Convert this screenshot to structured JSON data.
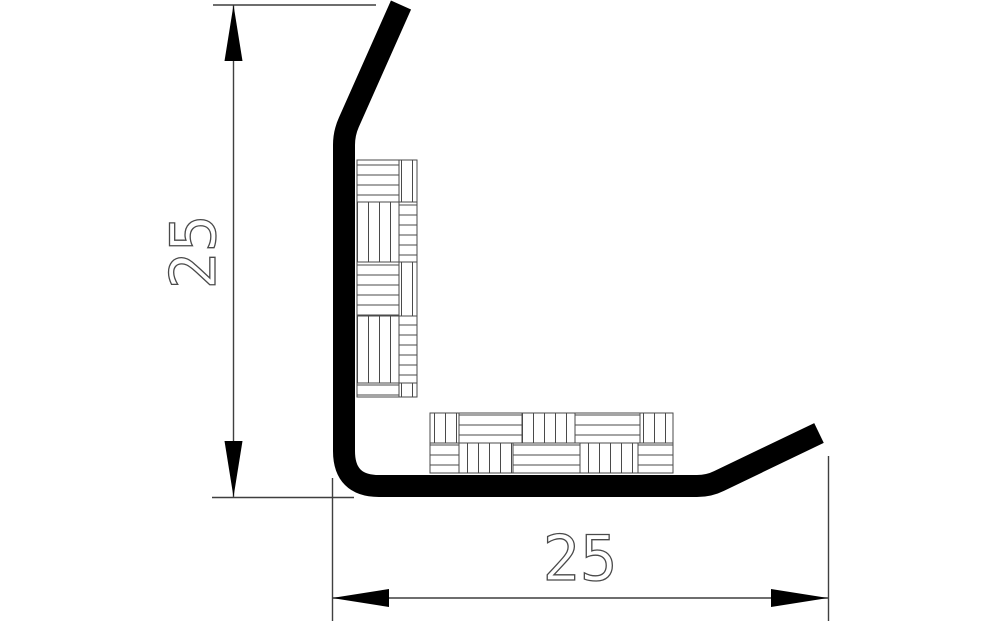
{
  "dimensions": {
    "height": {
      "value": "25",
      "orientation": "vertical"
    },
    "width": {
      "value": "25",
      "orientation": "horizontal"
    }
  },
  "colors": {
    "background": "#ffffff",
    "profile_fill": "#000000",
    "dimension_line": "#3f3f3f",
    "hatch_line": "#4a4a4a",
    "text_outline": "#4a4a4a"
  }
}
